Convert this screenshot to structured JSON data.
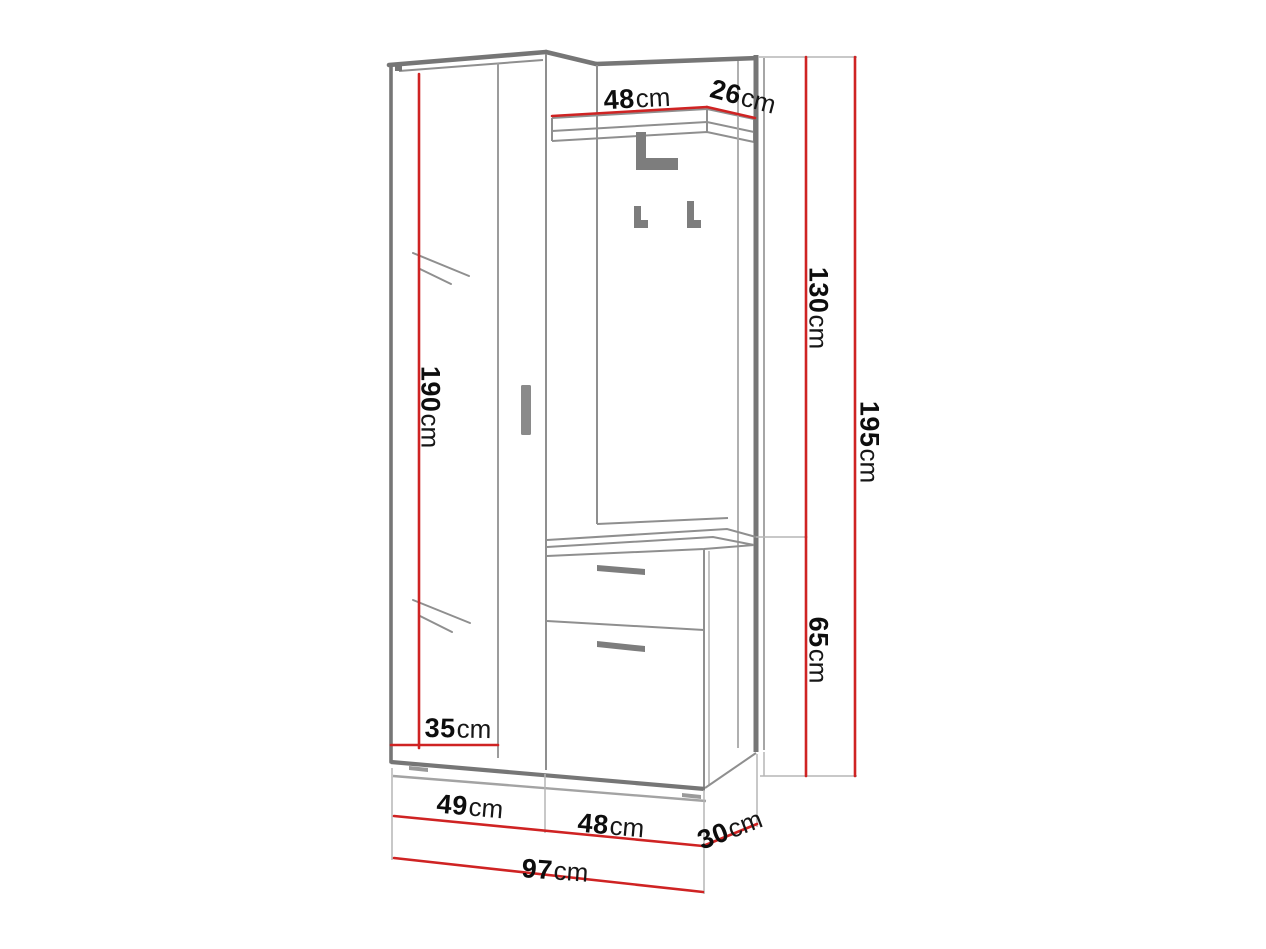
{
  "diagram": {
    "type": "furniture-dimension-drawing",
    "subject": "hallway wardrobe set with mirror, coat hooks and shoe cabinet",
    "unit": "cm",
    "colors": {
      "dimension_line": "#cf2323",
      "outline": "#8f8f8f",
      "outline_dark": "#767676",
      "extension_line": "#b5b5b5",
      "hardware": "#7d7d7d",
      "label_text": "#0d0d0d",
      "background": "#ffffff"
    },
    "dimensions": [
      {
        "id": "shelf-width",
        "value": "48",
        "unit": "cm"
      },
      {
        "id": "side-panel-depth",
        "value": "26",
        "unit": "cm"
      },
      {
        "id": "upper-section-height",
        "value": "130",
        "unit": "cm"
      },
      {
        "id": "total-height",
        "value": "195",
        "unit": "cm"
      },
      {
        "id": "mirror-door-height",
        "value": "190",
        "unit": "cm"
      },
      {
        "id": "lower-cabinet-height",
        "value": "65",
        "unit": "cm"
      },
      {
        "id": "mirror-door-width",
        "value": "35",
        "unit": "cm"
      },
      {
        "id": "wardrobe-width",
        "value": "49",
        "unit": "cm"
      },
      {
        "id": "lower-cabinet-width",
        "value": "48",
        "unit": "cm"
      },
      {
        "id": "lower-cabinet-depth",
        "value": "30",
        "unit": "cm"
      },
      {
        "id": "total-width",
        "value": "97",
        "unit": "cm"
      }
    ]
  }
}
